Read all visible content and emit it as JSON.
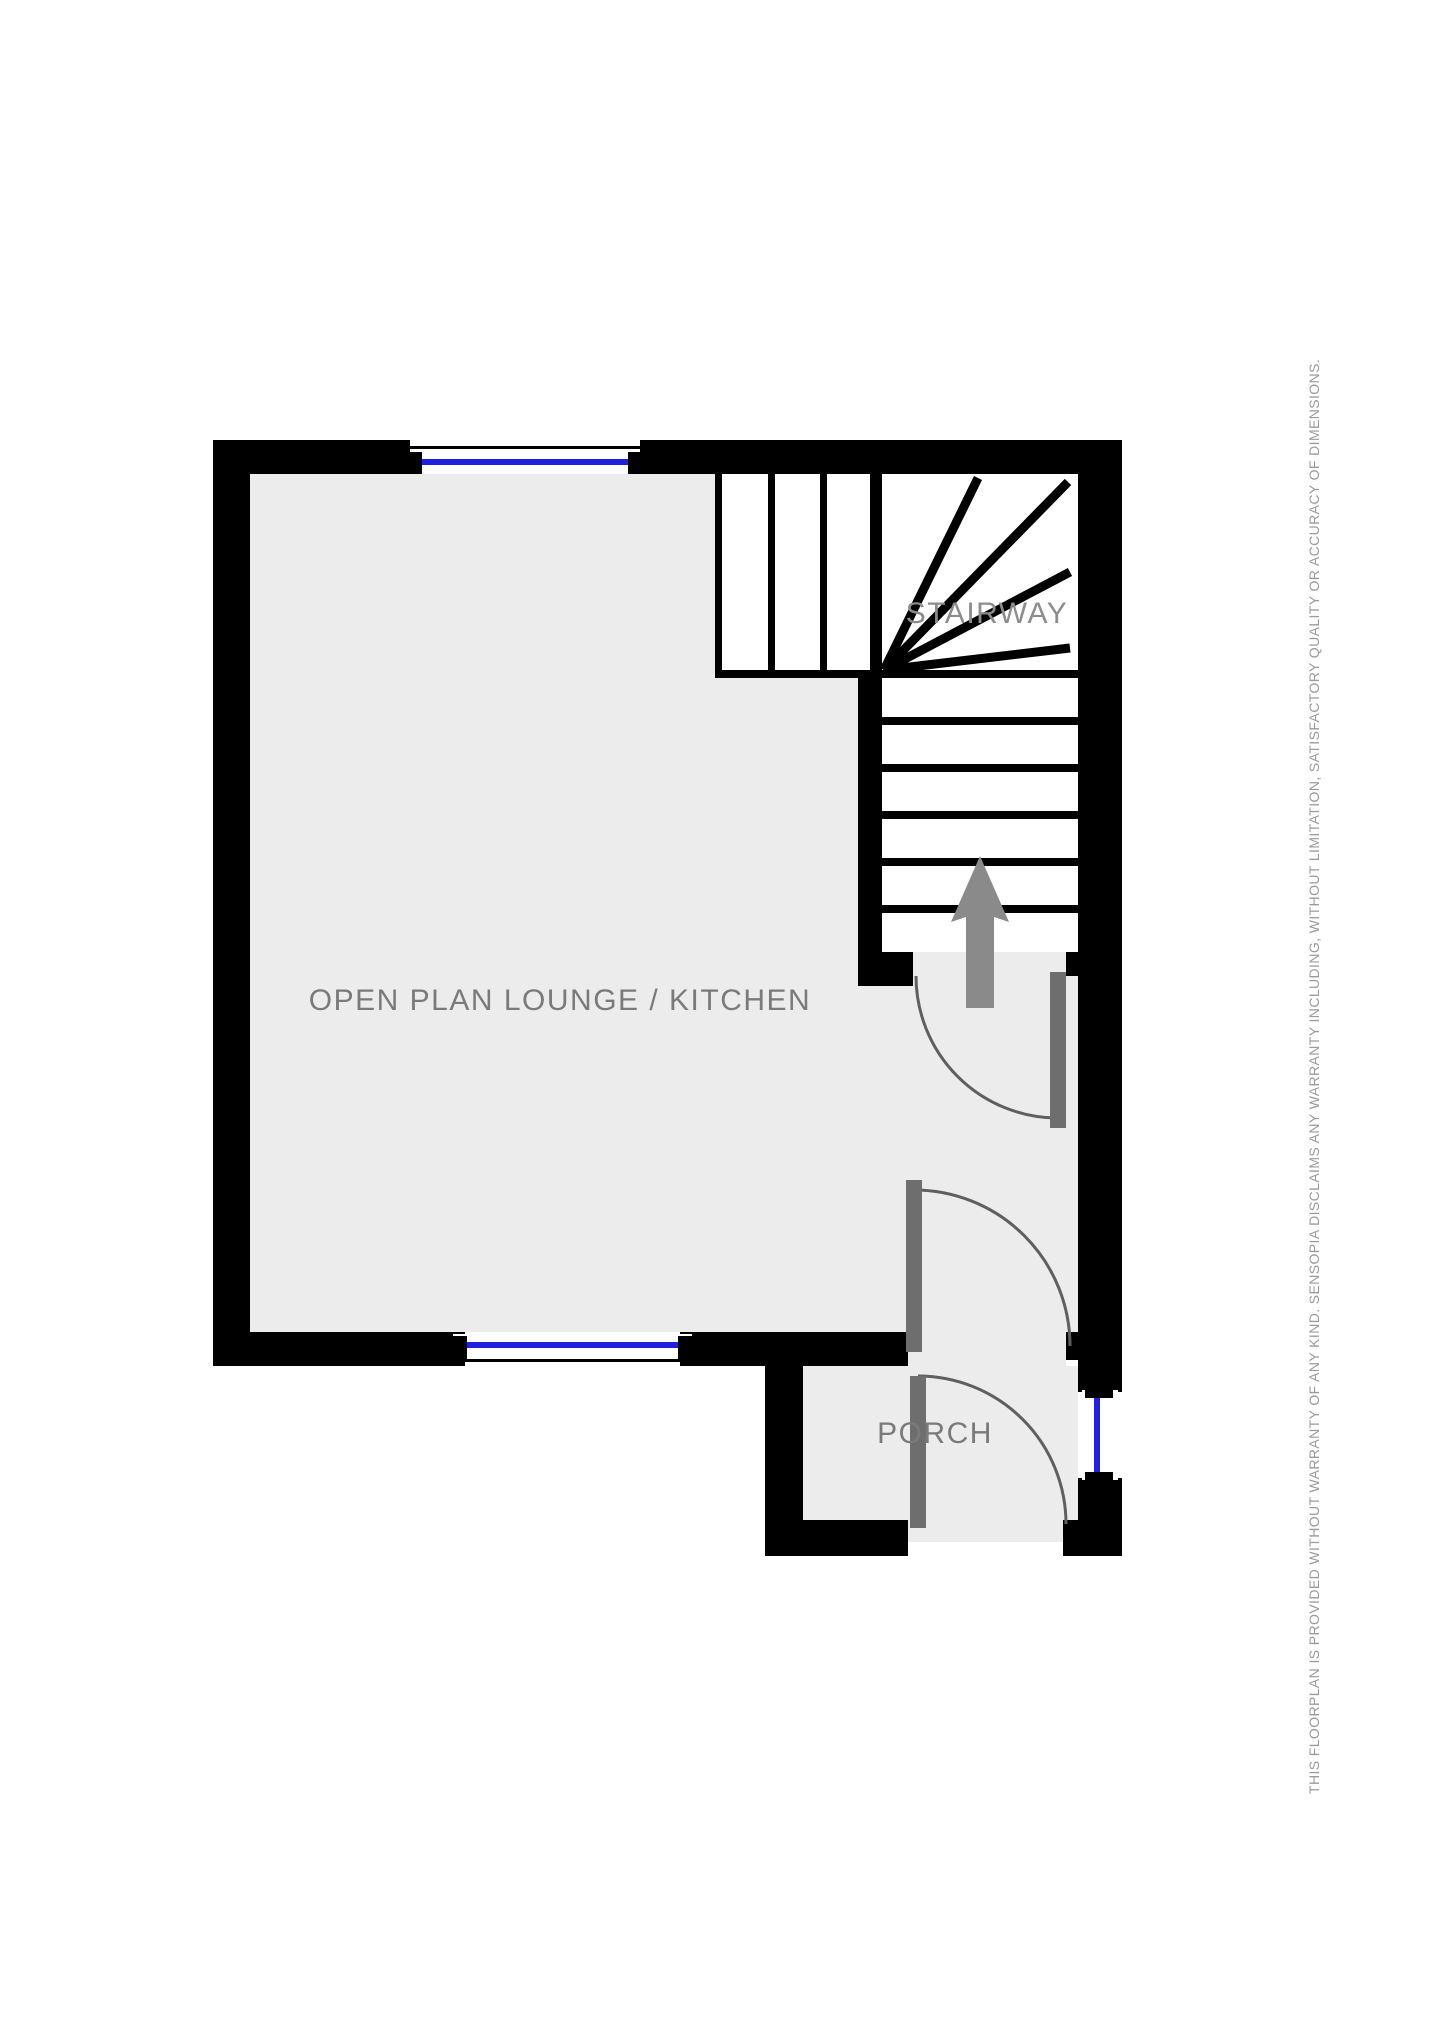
{
  "rooms": {
    "lounge": {
      "label": "OPEN PLAN LOUNGE / KITCHEN"
    },
    "stairway": {
      "label": "STAIRWAY"
    },
    "porch": {
      "label": "PORCH"
    }
  },
  "footnote": {
    "disclaimer": "THIS FLOORPLAN IS PROVIDED WITHOUT WARRANTY OF ANY KIND. SENSOPIA DISCLAIMS ANY WARRANTY INCLUDING, WITHOUT LIMITATION, SATISFACTORY QUALITY OR ACCURACY OF DIMENSIONS."
  },
  "colors": {
    "wall": "#000000",
    "floor": "#ececec",
    "stairs": "#ffffff",
    "window_glass": "#2020dd",
    "door_leaf": "#6e6e6e",
    "swing_arc": "#5f5f5f",
    "arrow": "#8a8a8a",
    "label_text": "#7a7a7a",
    "stairway_text": "#8c8c8c",
    "disclaimer_text": "#9a9a9a",
    "background": "#ffffff"
  }
}
